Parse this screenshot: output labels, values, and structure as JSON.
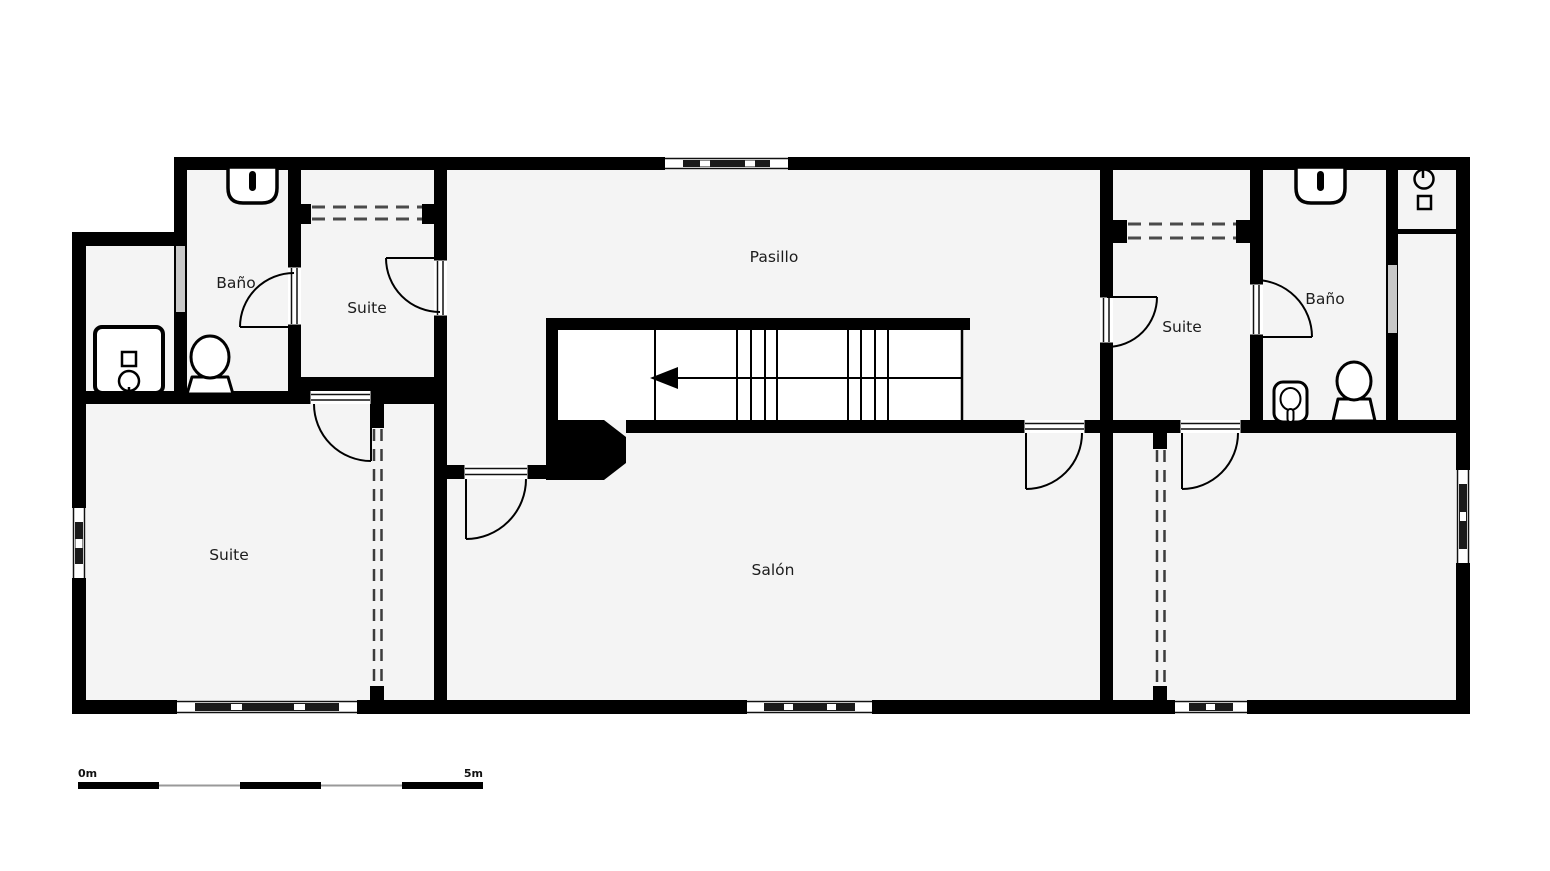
{
  "plan": {
    "type": "floor-plan",
    "rooms": [
      {
        "id": "bano-left",
        "label": "Baño"
      },
      {
        "id": "suite-top-left",
        "label": "Suite"
      },
      {
        "id": "pasillo",
        "label": "Pasillo"
      },
      {
        "id": "suite-top-right",
        "label": "Suite"
      },
      {
        "id": "bano-right",
        "label": "Baño"
      },
      {
        "id": "suite-bottom-left",
        "label": "Suite"
      },
      {
        "id": "salon",
        "label": "Salón"
      }
    ],
    "fixtures": [
      "sink-icon",
      "toilet-icon",
      "shower-icon",
      "bidet-icon",
      "shower-tap-icon",
      "stair-arrow-left-icon",
      "wardrobe-dashed",
      "sliding-partition-dashed"
    ],
    "scale_bar": {
      "start_label": "0m",
      "end_label": "5m"
    },
    "colors": {
      "wall": "#000000",
      "floor": "#f4f4f4",
      "glass": "#c8c8c8",
      "background": "#ffffff",
      "label_text": "#1c1c1c"
    }
  }
}
